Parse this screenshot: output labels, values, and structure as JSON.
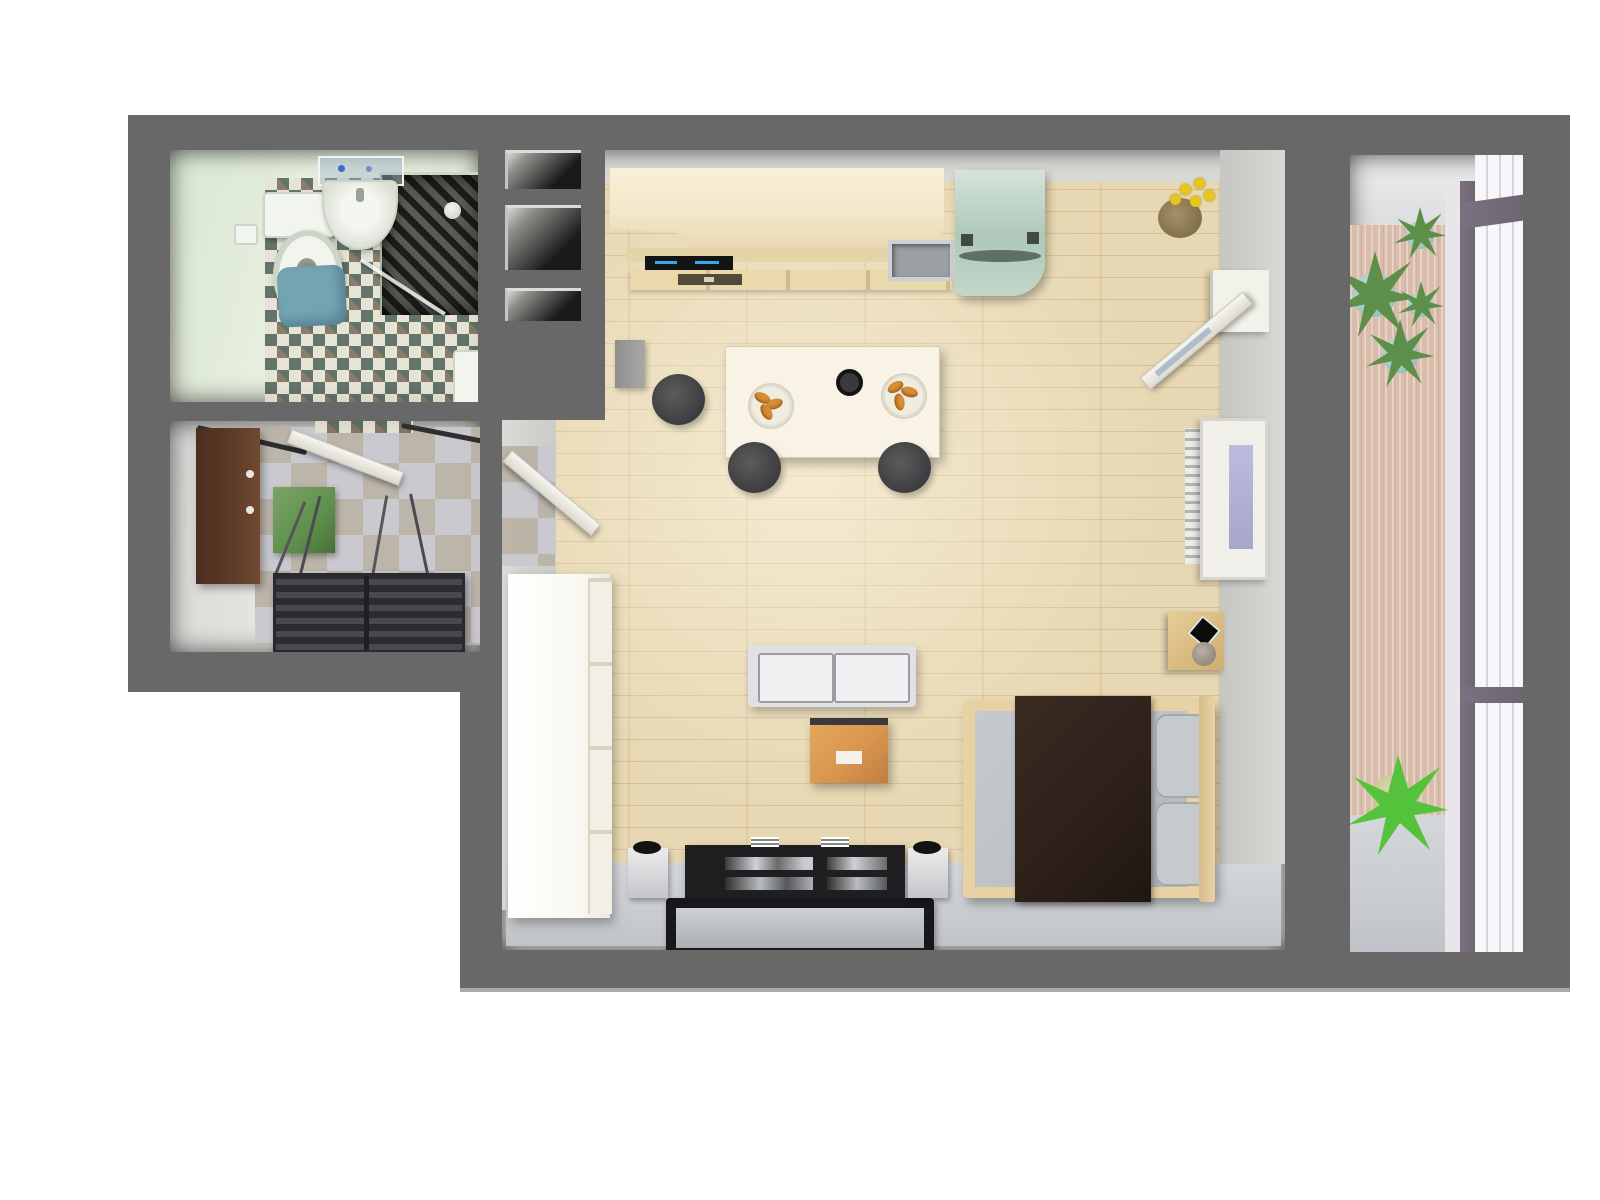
{
  "app": {
    "title": "Studio Apartment 3D Floor Plan - Top View Render",
    "view": "top-down orthographic 3D render",
    "text_visible_on_screen": "none"
  },
  "palette": {
    "bg": "#ffffff",
    "wall": "#686868",
    "bathWall": "#d9e6d2",
    "bathTileBase": "#e7e3d5",
    "bathTileDark": "#4e6058",
    "showerStone": "#3f423c",
    "matBlue": "#74a3b4",
    "hallTileA": "#c8c8ce",
    "hallTileB": "#bab3a6",
    "wardrobeBrown": "#5c3b28",
    "matGreen": "#5f8f4c",
    "bench": "#3c3c40",
    "woodFloor": "#e7d7b2",
    "grayFloor": "#c9ccd0",
    "counterWood": "#f2e7c8",
    "cooktop": "#141414",
    "cooktopBlue": "#35a8e8",
    "fridgeMint": "#afc8ba",
    "tableWhite": "#f8f3e4",
    "stool": "#474747",
    "food": "#d88e35",
    "sofa": "#dfe1e4",
    "cushion": "#eef0f2",
    "coffeeTable": "#d89550",
    "tv": "#1f1f22",
    "bedFrame": "#e8d2a4",
    "mattress": "#bdc0c5",
    "blanket": "#2e211a",
    "pillow": "#c6c9ce",
    "balconyFloor": "#d9bcaa",
    "windowMullion": "#6e6572",
    "glass": "#f7f7f9",
    "plantGreen": "#5e8f4a",
    "potTeal": "#9fc9c6",
    "flowerYellow": "#e6c51f"
  },
  "rooms": [
    {
      "name": "bathroom",
      "position": "top-left",
      "floor": "diamond checker tile (cream with teal/brown diamonds)",
      "items": [
        "toilet with cistern",
        "toilet paper holder",
        "round washbasin",
        "glass shelf with toiletries",
        "dark stone shower with glass screen",
        "shower head",
        "blue bath mat",
        "white shower tray corner"
      ]
    },
    {
      "name": "hallway",
      "position": "left-middle",
      "floor": "gray/tan checker tile",
      "items": [
        "brown wardrobe with two knobs",
        "two dark coat-rack rails",
        "open white door to bathroom",
        "green rug",
        "dark slatted shoe bench",
        "ski poles leaning on bench"
      ]
    },
    {
      "name": "storage-shafts",
      "position": "between bathroom and living room",
      "items": [
        "niche-1",
        "niche-2",
        "niche-3"
      ]
    },
    {
      "name": "living-room-kitchen",
      "position": "center-right, L-shaped wood floor with gray strip at bottom",
      "items": [
        "kitchen counter (light wood)",
        "black cooktop with two blue indicator strips",
        "drawer row with vent grille",
        "inset gray kitchen sink",
        "mint green refrigerator with dark hinges and handle",
        "small gray bin",
        "white dining table",
        "two plates with croissants",
        "black cup",
        "three dark round stools",
        "open white door to hallway over gray tiles",
        "tall white wardrobe with panelled doors",
        "light gray two-seat sofa",
        "orange coffee table with white card",
        "black TV console with glass shelves and two white brackets",
        "flat TV frame on floor",
        "two speakers on white stands",
        "wooden double bed",
        "gray mattress",
        "dark brown blanket",
        "two gray pillows",
        "wooden wall intercom with black screen and round knob",
        "white radiator fins",
        "window with lavender pane on right wall",
        "open white balcony door",
        "yellow flowers in brown pot"
      ]
    },
    {
      "name": "balcony",
      "position": "right column",
      "floor": "pink-beige vertical plank wood, gray pad at bottom",
      "items": [
        "four aloe plants in teal pots",
        "bright green floor plant in pale pot",
        "full-height glazed facade with dark mullions and white panes"
      ]
    }
  ]
}
